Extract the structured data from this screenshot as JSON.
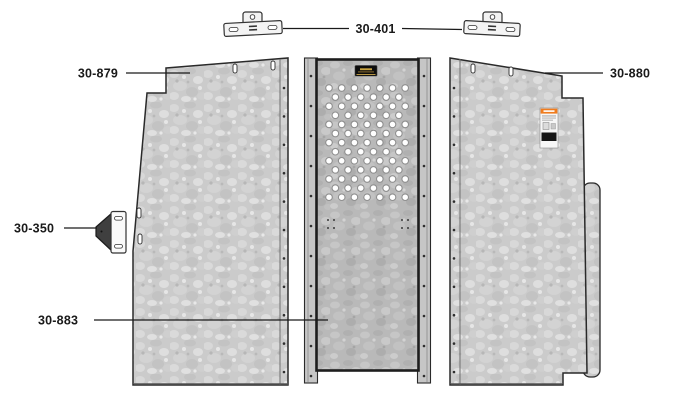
{
  "diagram_title": "Van partition panels parts diagram",
  "callouts": {
    "top_brackets": "30-401",
    "left_panel": "30-879",
    "right_panel": "30-880",
    "side_bracket": "30-350",
    "center_panel": "30-883"
  },
  "warning_label": {
    "header": "WARNING",
    "header_color": "#f07c1e"
  },
  "colors": {
    "panel_fill_base": "#cbcbcb",
    "center_panel_fill_base": "#b9b9b9",
    "outline": "#2a2a2a",
    "brand_plate_black": "#0d0d0d",
    "brand_gold": "#c9a441",
    "side_bracket_dark": "#3f3f3f",
    "hardware_white": "#f4f4f4",
    "callout_text": "#1a1a1a"
  },
  "decorations": {
    "perforations": {
      "x0": 329,
      "y0": 88,
      "dx": 12.7,
      "dy": 9.1,
      "rows": 13,
      "cols_even": 7,
      "cols_odd": 6,
      "r": 3.3
    },
    "rivet_columns": [
      {
        "x": 284,
        "y0": 88,
        "y1": 372,
        "step": 28.4
      },
      {
        "x": 311,
        "y0": 76,
        "y1": 376,
        "step": 30
      },
      {
        "x": 424,
        "y0": 76,
        "y1": 376,
        "step": 30
      },
      {
        "x": 454,
        "y0": 88,
        "y1": 372,
        "step": 28.4
      }
    ],
    "face_dots": [
      [
        578,
        122
      ],
      [
        578,
        176
      ],
      [
        579,
        260
      ],
      [
        328,
        220
      ],
      [
        334,
        220
      ],
      [
        328,
        228
      ],
      [
        334,
        228
      ],
      [
        402,
        220
      ],
      [
        408,
        220
      ],
      [
        402,
        228
      ],
      [
        408,
        228
      ]
    ]
  }
}
